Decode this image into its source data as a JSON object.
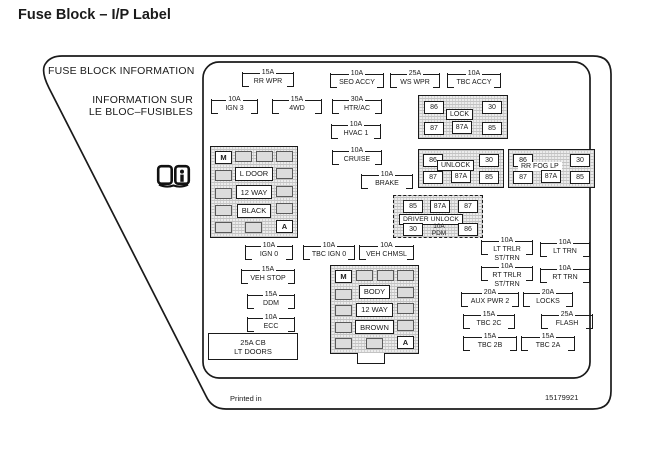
{
  "title": "Fuse Block – I/P Label",
  "panel": {
    "heading_en": "FUSE BLOCK INFORMATION",
    "heading_fr_line1": "INFORMATION SUR",
    "heading_fr_line2": "LE BLOC–FUSIBLES",
    "book_icon": "open-book-info-icon"
  },
  "fuses": [
    {
      "amp": "15A",
      "name": "RR WPR"
    },
    {
      "amp": "10A",
      "name": "SEO ACCY"
    },
    {
      "amp": "25A",
      "name": "WS WPR"
    },
    {
      "amp": "10A",
      "name": "TBC ACCY"
    },
    {
      "amp": "10A",
      "name": "IGN 3"
    },
    {
      "amp": "15A",
      "name": "4WD"
    },
    {
      "amp": "30A",
      "name": "HTR/AC"
    },
    {
      "amp": "10A",
      "name": "HVAC 1"
    },
    {
      "amp": "10A",
      "name": "CRUISE"
    },
    {
      "amp": "10A",
      "name": "BRAKE"
    },
    {
      "amp": "10A",
      "name": "IGN 0"
    },
    {
      "amp": "10A",
      "name": "TBC IGN 0"
    },
    {
      "amp": "10A",
      "name": "VEH CHMSL"
    },
    {
      "amp": "15A",
      "name": "VEH STOP"
    },
    {
      "amp": "15A",
      "name": "DDM"
    },
    {
      "amp": "10A",
      "name": "ECC"
    },
    {
      "amp": "10A",
      "name": "LT TRLR",
      "name2": "ST/TRN"
    },
    {
      "amp": "10A",
      "name": "LT TRN"
    },
    {
      "amp": "10A",
      "name": "RT TRLR",
      "name2": "ST/TRN"
    },
    {
      "amp": "10A",
      "name": "RT TRN"
    },
    {
      "amp": "20A",
      "name": "AUX PWR 2"
    },
    {
      "amp": "20A",
      "name": "LOCKS"
    },
    {
      "amp": "15A",
      "name": "TBC 2C"
    },
    {
      "amp": "25A",
      "name": "FLASH"
    },
    {
      "amp": "15A",
      "name": "TBC 2B"
    },
    {
      "amp": "15A",
      "name": "TBC 2A"
    }
  ],
  "relays": {
    "lock": {
      "label": "LOCK",
      "top_left": "86",
      "top_right": "30",
      "bottom_left": "87",
      "bottom_center": "87A",
      "bottom_right": "85"
    },
    "unlock": {
      "label": "UNLOCK",
      "top_left": "86",
      "top_right": "30",
      "bottom_left": "87",
      "bottom_center": "87A",
      "bottom_right": "85"
    },
    "rr_fog_lp": {
      "label": "RR FOG LP",
      "top_left": "86",
      "top_right": "30",
      "bottom_left": "87",
      "bottom_center": "87A",
      "bottom_right": "85"
    },
    "driver_unlock": {
      "label": "DRIVER UNLOCK",
      "top_left": "85",
      "top_center": "87A",
      "top_right": "87",
      "bottom_left": "30",
      "bottom_right": "86",
      "fuse_amp": "10A",
      "fuse_name": "PDM"
    }
  },
  "connector_blocks": {
    "l_door": {
      "corner_m": "M",
      "corner_a": "A",
      "line1": "L DOOR",
      "line2": "12 WAY",
      "line3": "BLACK"
    },
    "body": {
      "corner_m": "M",
      "corner_a": "A",
      "line1": "BODY",
      "line2": "12 WAY",
      "line3": "BROWN"
    }
  },
  "breaker": {
    "amp": "25A CB",
    "name": "LT DOORS"
  },
  "footer": {
    "printed_in": "Printed in",
    "part_number": "15179921"
  },
  "colors": {
    "line": "#1a1a1a",
    "stipple": "#ececec",
    "background": "#ffffff"
  }
}
